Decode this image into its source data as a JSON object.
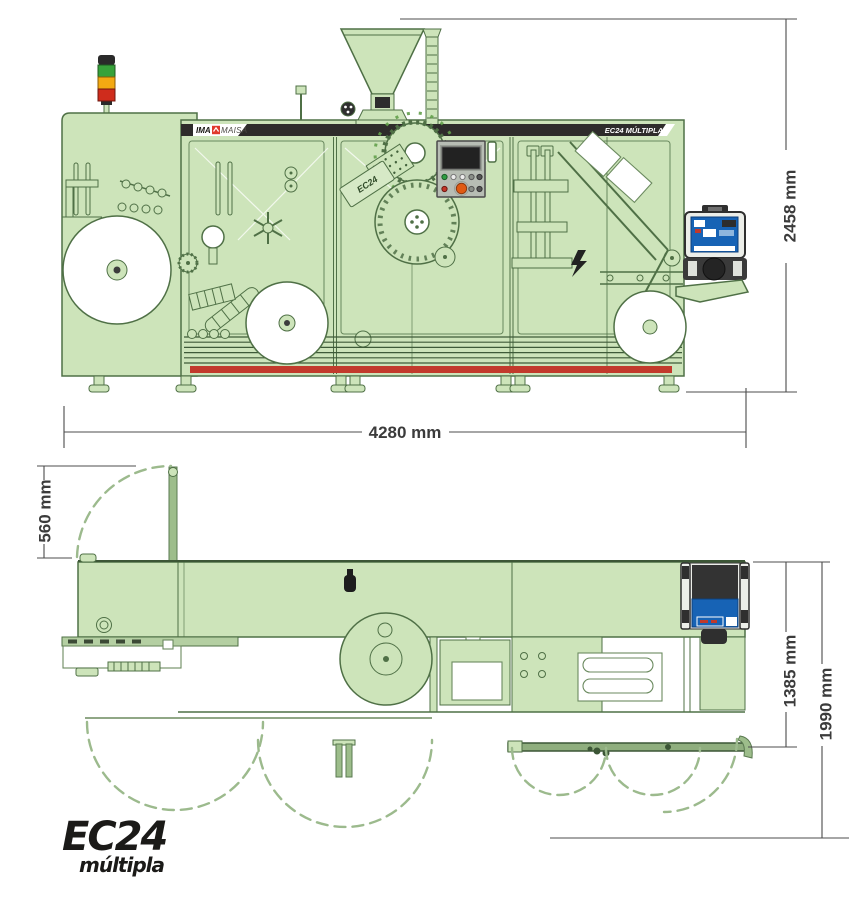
{
  "page": {
    "description": "Technical dimension drawing of a blister packaging machine: front elevation (top) and top plan view (bottom)"
  },
  "front_view": {
    "brand_strip": {
      "brand_bold": "IMA",
      "brand_light": "MAISA",
      "model_banner": "EC24 MÚLTIPLA"
    },
    "machine_plate_label": "EC24",
    "dimensions": {
      "height": "2458 mm",
      "width": "4280 mm"
    }
  },
  "plan_view": {
    "dimensions": {
      "rear_clearance": "560 mm",
      "machine_depth": "1385 mm",
      "total_depth": "1990 mm"
    }
  },
  "logo": {
    "model": "EC24",
    "series": "múltipla"
  },
  "colors": {
    "machine_fill": "#cde4ba",
    "machine_line": "#4f7046",
    "banner_dark": "#2e2c2b",
    "brand_red": "#e0392c",
    "safety_strip_red": "#c23a2c",
    "hmi_blue": "#1763b5",
    "stack_light_green": "#37a23a",
    "stack_light_yellow": "#f3a912",
    "stack_light_red": "#cf2c1c",
    "dimension_text": "#3b3b3b"
  }
}
